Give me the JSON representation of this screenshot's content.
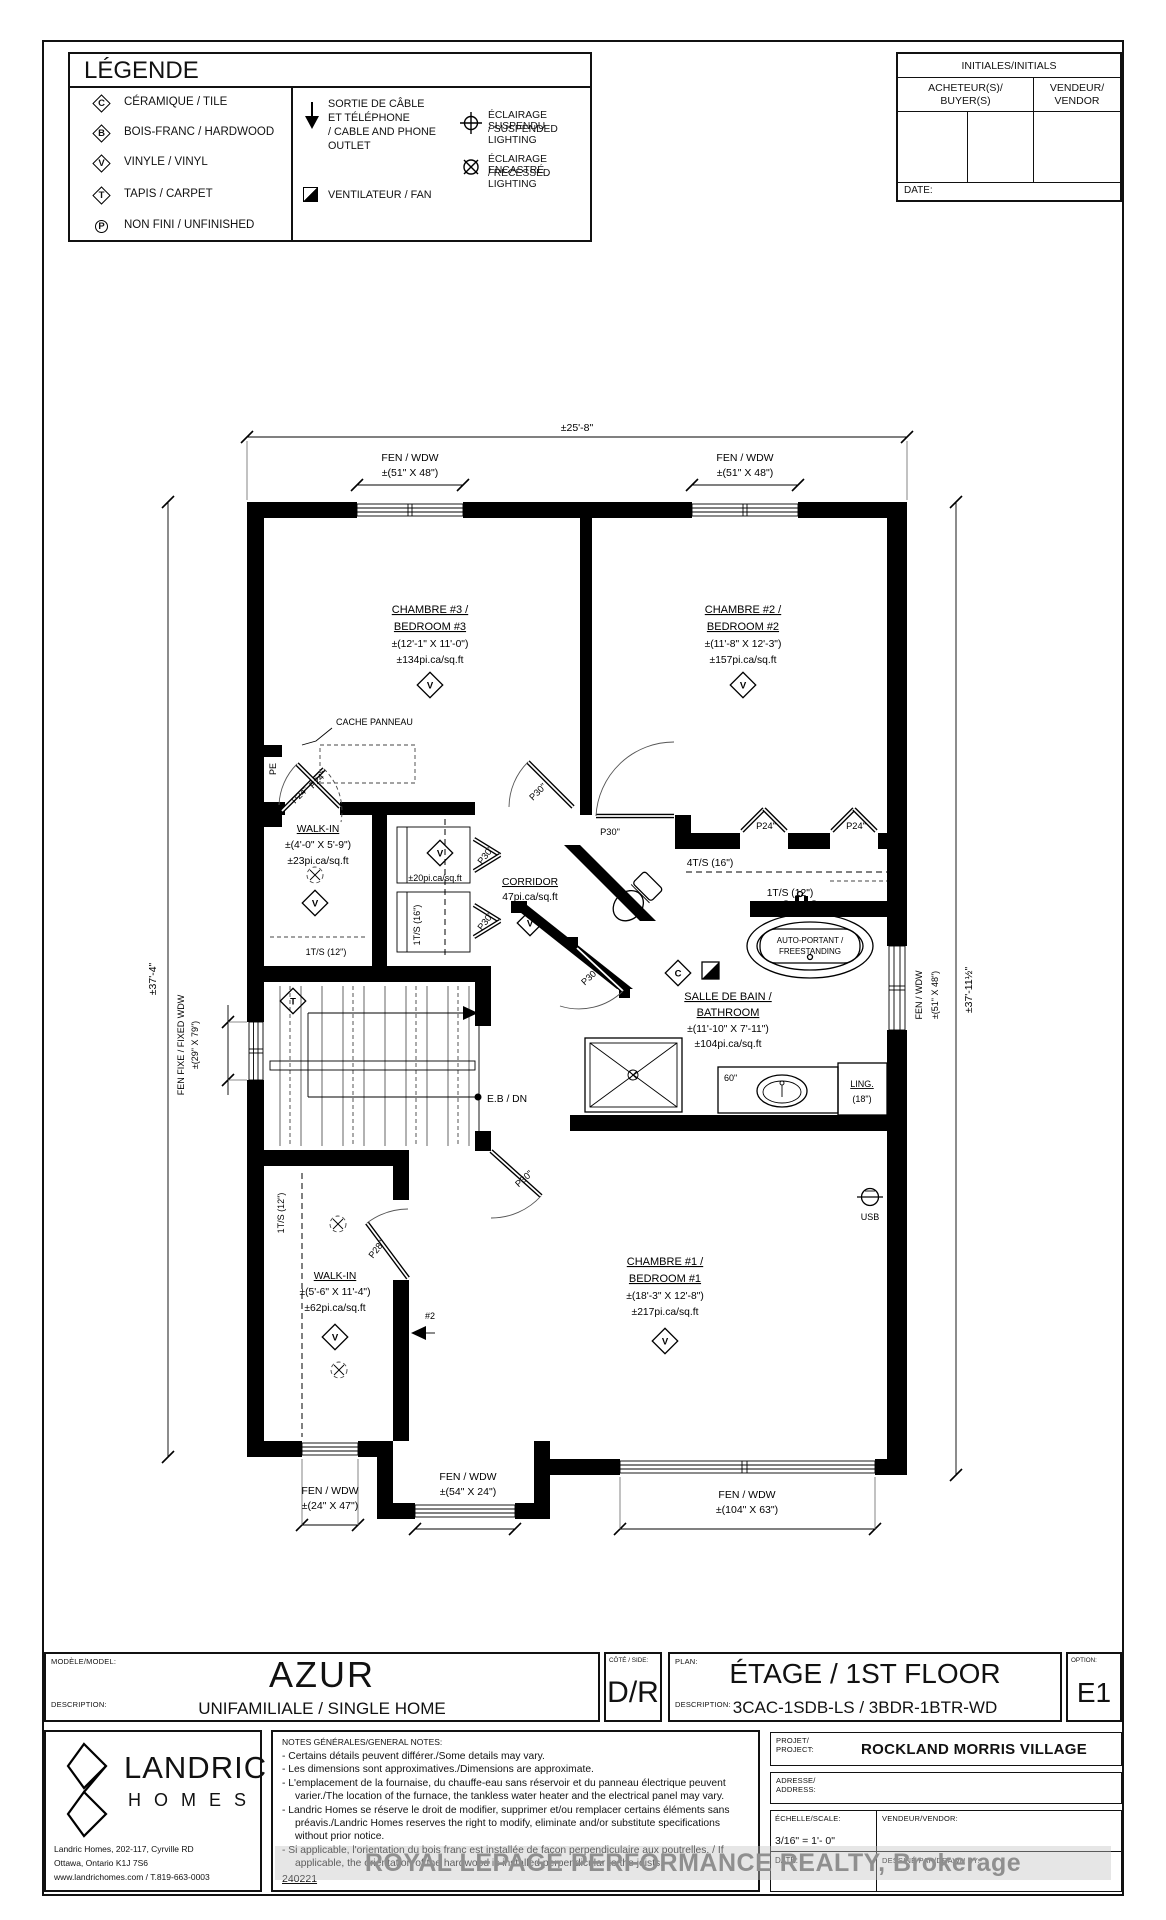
{
  "legend": {
    "title": "LÉGENDE",
    "items": [
      {
        "symbol": "C",
        "label": "CÉRAMIQUE / TILE"
      },
      {
        "symbol": "B",
        "label": "BOIS-FRANC / HARDWOOD"
      },
      {
        "symbol": "V",
        "label": "VINYLE / VINYL"
      },
      {
        "symbol": "T",
        "label": "TAPIS / CARPET"
      },
      {
        "symbol": "P",
        "label": "NON FINI / UNFINISHED"
      }
    ],
    "outlet_l1": "SORTIE DE CÂBLE",
    "outlet_l2": "ET TÉLÉPHONE",
    "outlet_l3": "/ CABLE AND PHONE",
    "outlet_l4": "OUTLET",
    "fan": "VENTILATEUR / FAN",
    "suspended_l1": "ÉCLAIRAGE SUSPENDU",
    "suspended_l2": "/ SUSPENDED LIGHTING",
    "recessed_l1": "ÉCLAIRAGE  ENCASTRÉ",
    "recessed_l2": "/ RECESSED LIGHTING"
  },
  "initials": {
    "header": "INITIALES/INITIALS",
    "buyer_l1": "ACHETEUR(S)/",
    "buyer_l2": "BUYER(S)",
    "vendor_l1": "VENDEUR/",
    "vendor_l2": "VENDOR",
    "date": "DATE:"
  },
  "plan": {
    "dim_top": "±25'-8\"",
    "dim_left": "±37'-4\"",
    "dim_right": "±37'-11½\"",
    "fen_wdw": "FEN / WDW",
    "win_51x48": "±(51\" X 48\")",
    "win_24x47": "±(24\" X 47\")",
    "win_54x24": "±(54\" X 24\")",
    "win_104x63": "±(104\" X 63\")",
    "fen_fixe_l1": "FEN FIXE / FIXED WDW",
    "fen_fixe_l2": "±(29\" X 79\")",
    "bedroom3": {
      "l1": "CHAMBRE #3 /",
      "l2": "BEDROOM #3",
      "l3": "±(12'-1\" X 11'-0\")",
      "l4": "±134pi.ca/sq.ft"
    },
    "bedroom2": {
      "l1": "CHAMBRE #2 /",
      "l2": "BEDROOM #2",
      "l3": "±(11'-8\" X 12'-3\")",
      "l4": "±157pi.ca/sq.ft"
    },
    "bedroom1": {
      "l1": "CHAMBRE #1 /",
      "l2": "BEDROOM #1",
      "l3": "±(18'-3\" X 12'-8\")",
      "l4": "±217pi.ca/sq.ft"
    },
    "walkin1": {
      "l1": "WALK-IN",
      "l2": "±(4'-0\" X 5'-9\")",
      "l3": "±23pi.ca/sq.ft"
    },
    "walkin2": {
      "l1": "WALK-IN",
      "l2": "±(5'-6\" X 11'-4\")",
      "l3": "±62pi.ca/sq.ft"
    },
    "corridor": {
      "l1": "CORRIDOR",
      "l2": "47pi.ca/sq.ft"
    },
    "bathroom": {
      "l1": "SALLE DE BAIN /",
      "l2": "BATHROOM",
      "l3": "±(11'-10\" X 7'-11\")",
      "l4": "±104pi.ca/sq.ft"
    },
    "cache_panneau": "CACHE PANNEAU",
    "pe": "PE",
    "linen_area": "±20pi.ca/sq.ft",
    "shelf_1ts16": "1T/S (16\")",
    "shelf_4ts16": "4T/S (16\")",
    "shelf_1ts12_walkin1": "1T/S (12\")",
    "shelf_1ts12_walkin2": "1T/S (12\")",
    "shelf_1ts12_bath": "1T/S (12\")",
    "tub_l1": "AUTO-PORTANT /",
    "tub_l2": "FREESTANDING",
    "ling_l1": "LING.",
    "ling_l2": "(18\")",
    "vanity_60": "60\"",
    "usb": "USB",
    "cable_2": "#2",
    "eb_dn": "E.B / DN",
    "door_p24": "P24\"",
    "door_p28": "P28\"",
    "door_p30": "P30\"",
    "symbols": {
      "v": "V",
      "c": "C",
      "t": "T"
    }
  },
  "titleblock": {
    "model_label": "MODÈLE/MODEL:",
    "model": "AZUR",
    "model_desc_label": "DESCRIPTION:",
    "model_desc": "UNIFAMILIALE / SINGLE HOME",
    "side_label": "CÔTÉ / SIDE:",
    "side": "D/R",
    "plan_label": "PLAN:",
    "plan_name": "ÉTAGE / 1ST FLOOR",
    "plan_desc_label": "DESCRIPTION:",
    "plan_desc": "3CAC-1SDB-LS / 3BDR-1BTR-WD",
    "option_label": "OPTION:",
    "option": "E1"
  },
  "footer": {
    "brand": "LANDRIC",
    "brand2": "H O M E S",
    "address_l1": "Landric Homes, 202-117, Cyrville RD",
    "address_l2": "Ottawa, Ontario K1J 7S6",
    "address_l3": "www.landrichomes.com / T.819-663-0003",
    "notes_title": "NOTES GÉNÉRALES/GENERAL NOTES:",
    "notes": [
      "-  Certains détails peuvent différer./Some details may vary.",
      "-  Les dimensions sont approximatives./Dimensions are approximate.",
      "-  L'emplacement de la fournaise, du chauffe-eau sans réservoir et du panneau électrique peuvent varier./The location of the furnace, the tankless water heater and the electrical panel may vary.",
      "-  Landric Homes se réserve le droit de modifier, supprimer et/ou remplacer certains éléments sans préavis./Landric Homes reserves the right to modify, eliminate and/or substitute specifications without prior notice.",
      "-  Si applicable, l'orientation du bois franc est installée de façon perpendiculaire aux poutrelles. / If applicable, the orientation of the hardwood is installed perpendicular to the joists."
    ],
    "doc_number": "240221",
    "watermark": "ROYAL LEPAGE PERFORMANCE REALTY, Brokerage",
    "project_label_l1": "PROJET/",
    "project_label_l2": "PROJECT:",
    "project": "ROCKLAND MORRIS VILLAGE",
    "address_label_l1": "ADRESSE/",
    "address_label_l2": "ADDRESS:",
    "scale_label": "ÉCHELLE/SCALE:",
    "scale": "3/16\" = 1'- 0\"",
    "vendor_label": "VENDEUR/VENDOR:",
    "date_label": "DATE:",
    "drawn_label": "DESSINÉ PAR/DRAWN BY:"
  }
}
